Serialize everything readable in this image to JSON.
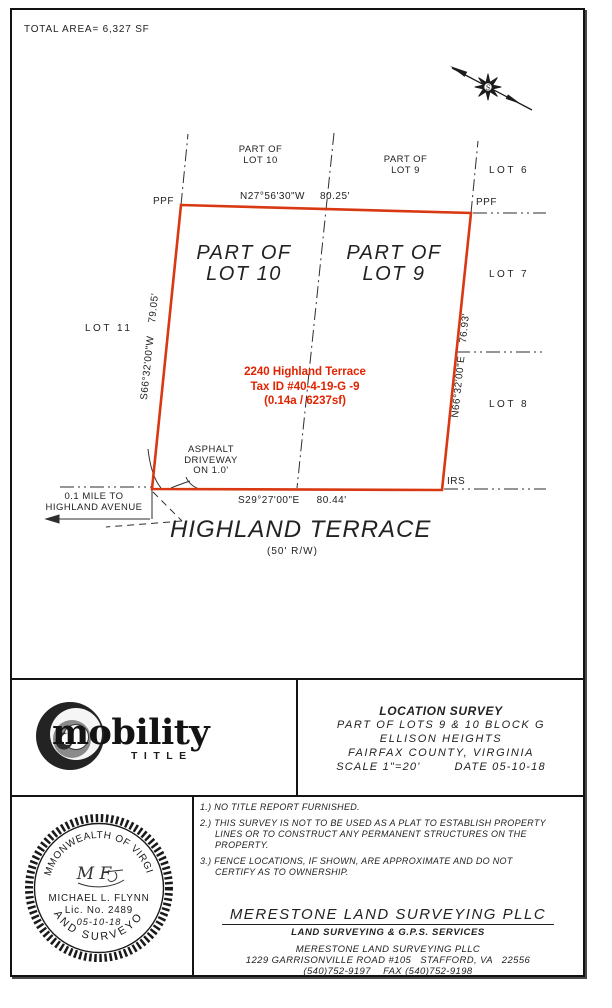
{
  "colors": {
    "boundary_red": "#d83812",
    "address_red": "#e12300",
    "linework": "#2e2e2e"
  },
  "header": {
    "total_area": "TOTAL AREA= 6,327 SF"
  },
  "plat": {
    "markers": {
      "ppf_left": "PPF",
      "ppf_right": "PPF",
      "irs": "IRS"
    },
    "lots": {
      "lot6": "LOT 6",
      "lot7": "LOT 7",
      "lot8": "LOT 8",
      "lot11": "LOT 11",
      "part10_small_1": "PART OF",
      "part10_small_2": "LOT 10",
      "part9_small_1": "PART OF",
      "part9_small_2": "LOT 9",
      "part10_big_1": "PART OF",
      "part10_big_2": "LOT 10",
      "part9_big_1": "PART OF",
      "part9_big_2": "LOT 9"
    },
    "bearings": {
      "top": "N27°56'30\"W",
      "top_dist": "80.25'",
      "left": "S66°32'00\"W",
      "left_dist": "79.05'",
      "right": "N66°32'00\"E",
      "right_dist": "76.93'",
      "bottom": "S29°27'00\"E",
      "bottom_dist": "80.44'"
    },
    "address": {
      "line1": "2240 Highland Terrace",
      "line2": "Tax ID #40-4-19-G -9",
      "line3": "(0.14a / 6237sf)"
    },
    "driveway_note": {
      "line1": "ASPHALT",
      "line2": "DRIVEWAY",
      "line3": "ON 1.0'"
    },
    "distance_note": {
      "line1": "0.1 MILE TO",
      "line2": "HIGHLAND AVENUE"
    },
    "street": {
      "name": "HIGHLAND TERRACE",
      "rw": "(50' R/W)"
    },
    "north_arrow_glyph": "S"
  },
  "title_block": {
    "title": "LOCATION SURVEY",
    "line2": "PART OF LOTS 9 & 10 BLOCK G",
    "line3": "ELLISON HEIGHTS",
    "line4": "FAIRFAX COUNTY, VIRGINIA",
    "scale": "SCALE 1\"=20'",
    "date": "DATE 05-10-18"
  },
  "logo": {
    "word": "mobility",
    "sub": "TITLE"
  },
  "notes": [
    {
      "text": "1.) NO TITLE REPORT FURNISHED."
    },
    {
      "text": "2.) THIS SURVEY IS NOT TO BE USED AS A PLAT TO ESTABLISH PROPERTY LINES OR TO CONSTRUCT ANY PERMANENT STRUCTURES ON THE PROPERTY."
    },
    {
      "text": "3.) FENCE LOCATIONS, IF SHOWN, ARE APPROXIMATE AND DO NOT CERTIFY AS TO OWNERSHIP."
    }
  ],
  "seal": {
    "arc_top": "COMMONWEALTH OF VIRGINIA",
    "arc_bottom": "LAND SURVEYOR",
    "signature": "M F",
    "name": "MICHAEL L. FLYNN",
    "license": "Lic. No. 2489",
    "date": "05-10-18"
  },
  "company": {
    "heading": "MERESTONE LAND SURVEYING PLLC",
    "services": "LAND SURVEYING & G.P.S. SERVICES",
    "name": "MERESTONE LAND SURVEYING PLLC",
    "address": "1229 GARRISONVILLE ROAD #105   STAFFORD, VA   22556",
    "phone": "(540)752-9197    FAX (540)752-9198"
  }
}
